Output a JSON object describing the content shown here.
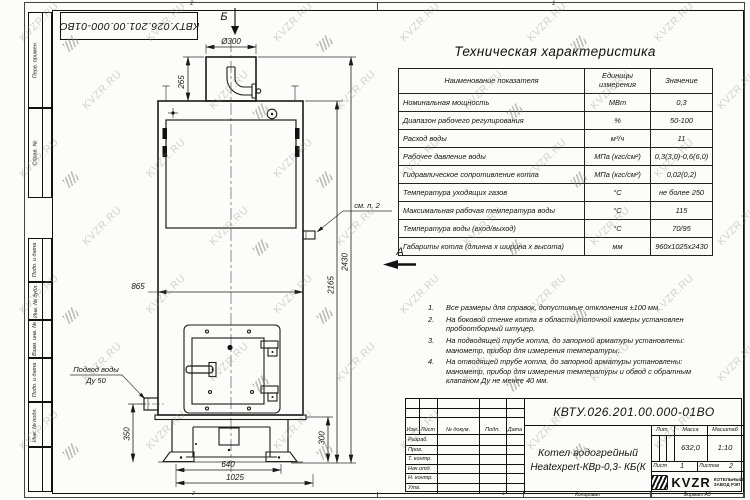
{
  "watermark": {
    "text": "KVZR.RU"
  },
  "sheet": {
    "stamp_top": "КВТУ.026.201.00.000-01ВО",
    "margin_labels": [
      "Перв. примен.",
      "Справ. №",
      "Подп. и дата",
      "Инв. № дубл.",
      "Взам. инв. №",
      "Подп. и дата",
      "Инв. № подл."
    ],
    "zone_top_left": "2",
    "zone_top_right": "1",
    "zone_bottom_left": "2",
    "zone_bottom_right": "1",
    "kopiroval": "Копировал",
    "format_label": "Формат А3"
  },
  "drawing": {
    "view_top": "Б",
    "view_side": "А",
    "labels": {
      "see_note": "см. п. 2",
      "water_supply_1": "Подвод воды",
      "water_supply_2": "Ду 50"
    },
    "dims": {
      "flue_diameter": "Ø300",
      "flue_height": "265",
      "body_width": "865",
      "total_height": "2430",
      "body_height": "2165",
      "inlet_height": "350",
      "base_height": "300",
      "base_opening_width": "640",
      "base_width": "1025"
    }
  },
  "table": {
    "title": "Техническая характеристика",
    "headers": [
      "Наименование показателя",
      "Единицы измерения",
      "Значение"
    ],
    "rows": [
      [
        "Номинальная мощность",
        "МВт",
        "0,3"
      ],
      [
        "Диапазон рабочего регулирования",
        "%",
        "50-100"
      ],
      [
        "Расход воды",
        "м³/ч",
        "11"
      ],
      [
        "Рабочее давление воды",
        "МПа (кгс/см²)",
        "0,3(3,0)-0,6(6,0)"
      ],
      [
        "Гидравлическое сопротивление котла",
        "МПа (кгс/см²)",
        "0,02(0,2)"
      ],
      [
        "Температура уходящих газов",
        "°С",
        "не более 250"
      ],
      [
        "Максимальная рабочая температура воды",
        "°С",
        "115"
      ],
      [
        "Температура воды (вход/выход)",
        "°С",
        "70/95"
      ],
      [
        "Габариты котла (длинна х ширина х высота)",
        "мм",
        "960х1025х2430"
      ]
    ]
  },
  "notes": [
    "Все размеры для справок, допустимые отклонения ±100 мм.",
    "На боковой стенке котла в области топочной камеры установлен пробоотборный штуцер.",
    "На подводящей трубе котла, до запорной арматуры установлены: манометр, прибор для измерения температуры.",
    "На отводящей трубе котла, до запорной арматуры установлены: манометр, прибор для измерения температуры и обвод с обратным клапаном Ду не менее 40 мм."
  ],
  "title_block": {
    "doc_number": "КВТУ.026.201.00.000-01ВО",
    "product_name_1": "Котел водогрейный",
    "product_name_2": "Heatexpert-КВр-0,3- КБ(К",
    "col_headers": [
      "Изм.",
      "Лист",
      "№ докум.",
      "Подп.",
      "Дата"
    ],
    "row_labels": [
      "Разраб.",
      "Пров.",
      "Т. контр.",
      "Нач.отд.",
      "Н. контр.",
      "Утв."
    ],
    "lit_label": "Лит.",
    "mass_label": "Масса",
    "scale_label": "Масштаб",
    "mass_value": "632,0",
    "scale_value": "1:10",
    "sheet_label": "Лист",
    "sheet_number": "1",
    "sheets_label": "Листов",
    "sheets_total": "2",
    "company_logo": "KVZR",
    "company_name_1": "КОТЕЛЬНЫЙ",
    "company_name_2": "ЗАВОД РЭП"
  }
}
